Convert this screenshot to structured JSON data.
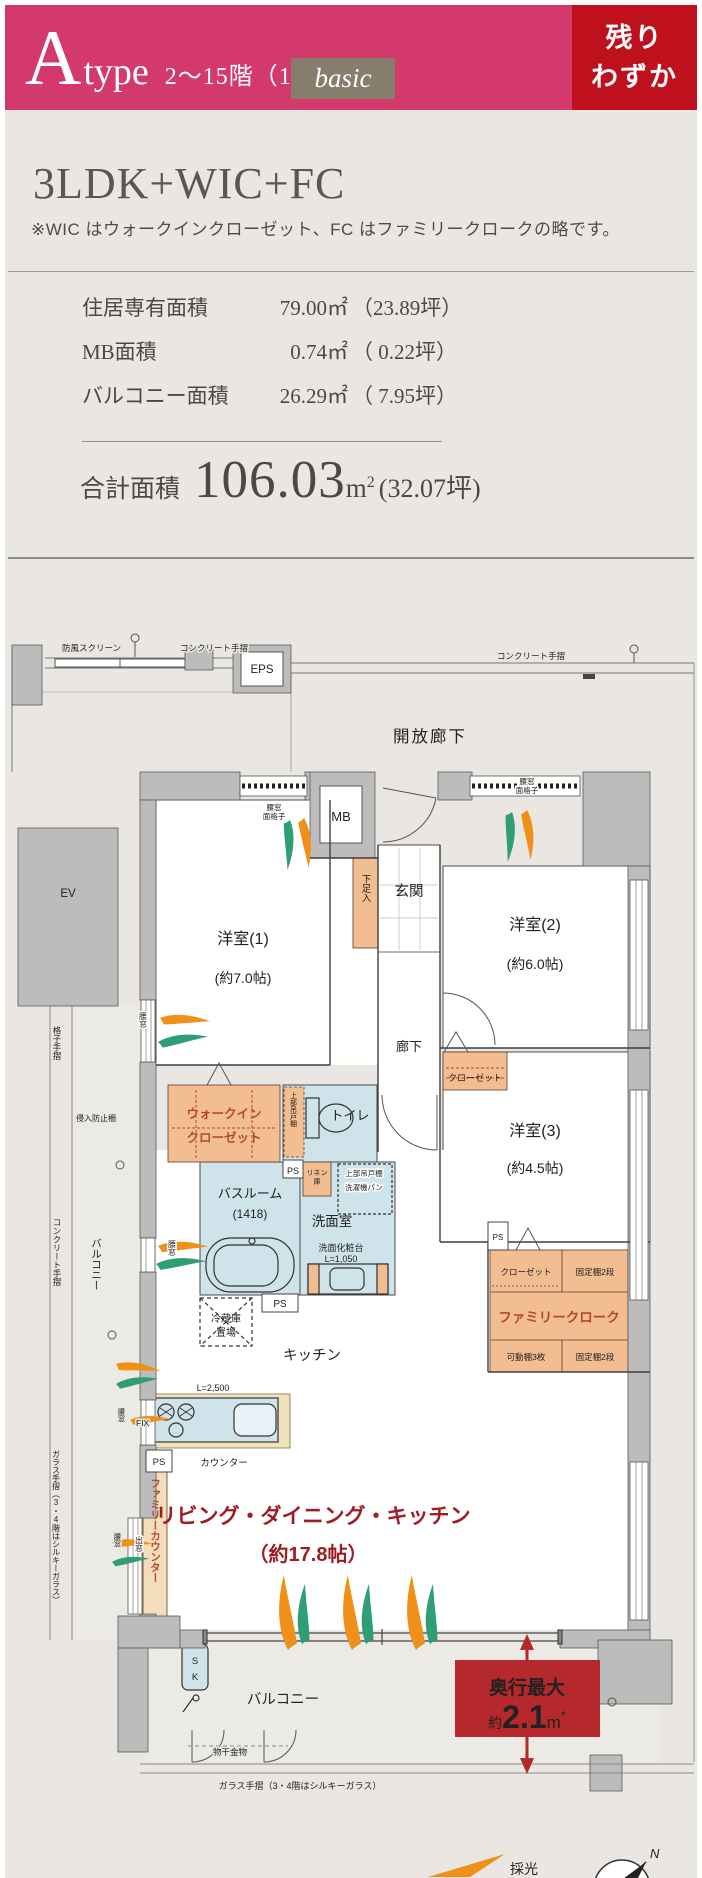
{
  "header": {
    "type_letter": "A",
    "type_word": "type",
    "floors_info": "2〜15階（14戸）",
    "basic_badge": "basic",
    "availability_line1": "残り",
    "availability_line2": "わずか",
    "colors": {
      "pink": "#d4396b",
      "red": "#bf101e",
      "badge_gray": "#867e6c"
    }
  },
  "summary": {
    "plan_title": "3LDK+WIC+FC",
    "note": "※WIC はウォークインクローゼット、FC はファミリークロークの略です。",
    "area_rows": [
      {
        "label": "住居専有面積",
        "value": "79.00㎡",
        "tsubo": "（23.89坪）"
      },
      {
        "label": "MB面積",
        "value": "0.74㎡",
        "tsubo": "（ 0.22坪）"
      },
      {
        "label": "バルコニー面積",
        "value": "26.29㎡",
        "tsubo": "（ 7.95坪）"
      }
    ],
    "total_label": "合計面積",
    "total_value": "106.03",
    "total_unit": "m",
    "total_sup": "2",
    "total_tsubo": "(32.07坪)"
  },
  "plan": {
    "labels": {
      "windbreak": "防風スクリーン",
      "concrete_rail": "コンクリート手摺",
      "eps": "EPS",
      "open_corridor": "開放廊下",
      "mb": "MB",
      "koshimado": "腰窓",
      "menkoshi": "面格子",
      "ev": "EV",
      "genkan": "玄関",
      "getabako": "下足入",
      "room1": "洋室(1)",
      "room1_size": "(約7.0帖)",
      "room2": "洋室(2)",
      "room2_size": "(約6.0帖)",
      "room3": "洋室(3)",
      "room3_size": "(約4.5帖)",
      "koshi_tesuri": "格子手摺",
      "shinnyu": "侵入防止柵",
      "wic1": "ウォークイン",
      "wic2": "クローゼット",
      "rouka": "廊下",
      "closet": "クローゼット",
      "jobu_tsuridana": "上部吊戸棚",
      "toilet": "トイレ",
      "ps": "PS",
      "linen1": "リネン",
      "linen2": "庫",
      "sentakuki": "洗濯機パン",
      "bath1": "バスルーム",
      "bath2": "(1418)",
      "senmen": "洗面室",
      "vanity1": "洗面化粧台",
      "vanity2": "L=1,050",
      "balcony": "バルコニー",
      "fridge1": "冷蔵庫",
      "fridge2": "置場",
      "kitchen": "キッチン",
      "family_cloak": "ファミリークローク",
      "fixed_shelf": "固定棚2段",
      "movable_shelf": "可動棚3枚",
      "l2500": "L=2,500",
      "fix": "FIX",
      "counter": "カウンター",
      "family_counter": "ファミリーカウンター",
      "demado": "出窓",
      "glass_rail": "ガラス手摺（3・4階はシルキーガラス）",
      "ldk": "リビング・ダイニング・キッチン",
      "ldk_size": "（約17.8帖）",
      "sk1": "S",
      "sk2": "K",
      "monohoshi": "物干金物",
      "saiko": "採光",
      "north": "N"
    },
    "depth_badge": {
      "label": "奥行最大",
      "prefix": "約",
      "value": "2.1",
      "unit": "m",
      "asterisk": "*"
    },
    "colors": {
      "wall": "#bcbcbc",
      "wet": "#cfe3eb",
      "closet": "#f3bd92",
      "counter_beige": "#f0e3bb",
      "label_red": "#b2492f",
      "ldk_red": "#9e1d22",
      "arrow_orange": "#ef9018",
      "arrow_green": "#2f9e72",
      "badge_red": "#b5282c",
      "balcony_floor": "#eceae4"
    }
  }
}
